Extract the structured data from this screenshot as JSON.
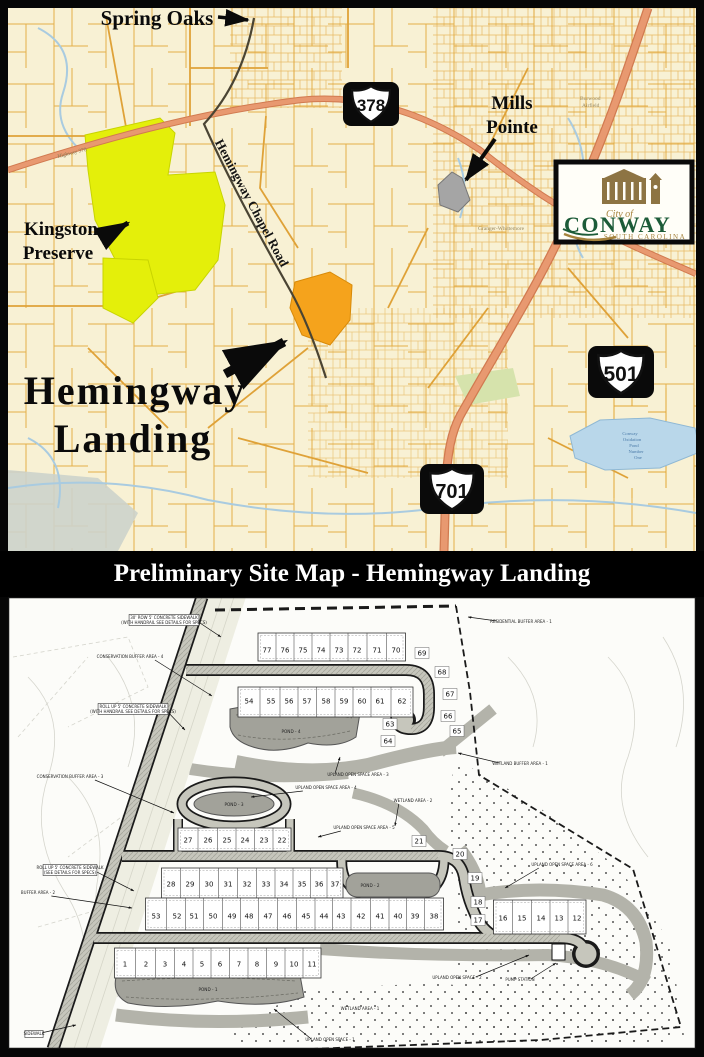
{
  "location_map": {
    "labels": {
      "spring_oaks": "Spring Oaks",
      "mills_pointe": [
        "Mills",
        "Pointe"
      ],
      "kingston": [
        "Kingston",
        "Preserve"
      ],
      "hemingway": [
        "Hemingway",
        "Landing"
      ],
      "road_name": "Hemingway Chapel Road",
      "highway_small": "Highway 378",
      "granger": "Granger-Whittemore",
      "burwood": [
        "Burwood",
        "Airfield"
      ],
      "lake": [
        "Conway",
        "Oxidation",
        "Pond",
        "Number",
        "One"
      ]
    },
    "shields": [
      {
        "number": "378"
      },
      {
        "number": "501"
      },
      {
        "number": "701"
      }
    ],
    "logo": {
      "prefix": "City of",
      "name": "CONWAY",
      "sub": "SOUTH CAROLINA"
    },
    "colors": {
      "map_bg": "#f8f1d4",
      "parcel_line": "#e1a430",
      "major_road": "#e89970",
      "water": "#b9d7ea",
      "preserve_yellow": "#e4ef0a",
      "site_orange": "#f5a31c",
      "pointe_gray": "#a5a5a5",
      "logo_green": "#1c5b38",
      "logo_gold": "#a5823c"
    }
  },
  "title_bar": {
    "text": "Preliminary Site Map - Hemingway Landing"
  },
  "site_plan": {
    "rows": [
      {
        "nums": [
          "77",
          "76",
          "75",
          "74",
          "73",
          "72",
          "71",
          "70"
        ],
        "xs": [
          259,
          277,
          295,
          313,
          331,
          349,
          369,
          388
        ],
        "yNum": 53,
        "y0": 36,
        "y1": 64
      },
      {
        "nums": [
          "54",
          "55",
          "56",
          "57",
          "58",
          "59",
          "60",
          "61",
          "62"
        ],
        "xs": [
          241,
          263,
          281,
          299,
          318,
          336,
          354,
          372,
          394
        ],
        "yNum": 104,
        "y0": 90,
        "y1": 120
      },
      {
        "nums": [
          "27",
          "26",
          "25",
          "24",
          "23",
          "22"
        ],
        "xs": [
          180,
          200,
          219,
          237,
          256,
          274
        ],
        "yNum": 243,
        "y0": 231,
        "y1": 254
      },
      {
        "nums": [
          "28",
          "29",
          "30",
          "31",
          "32",
          "33",
          "34",
          "35",
          "36",
          "37"
        ],
        "xs": [
          163,
          182,
          201,
          220,
          239,
          258,
          276,
          294,
          311,
          327
        ],
        "yNum": 287,
        "y0": 271,
        "y1": 301
      },
      {
        "nums": [
          "53",
          "52",
          "51",
          "50",
          "49",
          "48",
          "47",
          "46",
          "45",
          "44",
          "43",
          "42",
          "41",
          "40",
          "39",
          "38"
        ],
        "xs": [
          148,
          169,
          186,
          205,
          224,
          241,
          260,
          279,
          298,
          316,
          333,
          353,
          372,
          390,
          407,
          426
        ],
        "yNum": 319,
        "y0": 301,
        "y1": 333
      },
      {
        "nums": [
          "1",
          "2",
          "3",
          "4",
          "5",
          "6",
          "7",
          "8",
          "9",
          "10",
          "11"
        ],
        "xs": [
          117,
          138,
          157,
          176,
          194,
          212,
          231,
          249,
          268,
          286,
          304
        ],
        "yNum": 367,
        "y0": 351,
        "y1": 381
      },
      {
        "nums": [
          "16",
          "15",
          "14",
          "13",
          "12"
        ],
        "xs": [
          495,
          514,
          533,
          551,
          569
        ],
        "yNum": 321,
        "y0": 303,
        "y1": 337
      }
    ],
    "singles": [
      {
        "n": "69",
        "x": 414,
        "y": 56
      },
      {
        "n": "68",
        "x": 434,
        "y": 75
      },
      {
        "n": "67",
        "x": 442,
        "y": 97
      },
      {
        "n": "66",
        "x": 440,
        "y": 119
      },
      {
        "n": "65",
        "x": 449,
        "y": 134
      },
      {
        "n": "63",
        "x": 382,
        "y": 127
      },
      {
        "n": "64",
        "x": 380,
        "y": 144
      },
      {
        "n": "21",
        "x": 411,
        "y": 244
      },
      {
        "n": "20",
        "x": 452,
        "y": 257
      },
      {
        "n": "19",
        "x": 467,
        "y": 281
      },
      {
        "n": "18",
        "x": 470,
        "y": 305
      },
      {
        "n": "17",
        "x": 470,
        "y": 323
      }
    ],
    "ponds": [
      {
        "label": "POND - 4",
        "x": 283,
        "y": 136
      },
      {
        "label": "POND - 3",
        "x": 226,
        "y": 209
      },
      {
        "label": "POND - 2",
        "x": 362,
        "y": 290
      },
      {
        "label": "POND - 1",
        "x": 200,
        "y": 394
      }
    ],
    "annotations": [
      {
        "t": "30' ROW 5' CONCRETE SIDEWALK",
        "t2": "(WITH HANDRAIL SEE DETAILS FOR SPECS)",
        "x": 156,
        "y": 22,
        "box": true,
        "ax": 213,
        "ay": 40
      },
      {
        "t": "CONSERVATION BUFFER AREA - 4",
        "x": 122,
        "y": 61,
        "ax": 204,
        "ay": 99
      },
      {
        "t": "ROLL UP 5' CONCRETE SIDEWALK",
        "t2": "(WITH HANDRAIL SEE DETAILS FOR SPECS)",
        "x": 125,
        "y": 111,
        "box": true,
        "ax": 177,
        "ay": 133
      },
      {
        "t": "RESIDENTIAL BUFFER AREA - 1",
        "x": 513,
        "y": 26,
        "ax": 460,
        "ay": 20
      },
      {
        "t": "WETLAND BUFFER AREA - 1",
        "x": 512,
        "y": 168,
        "ax": 450,
        "ay": 156
      },
      {
        "t": "WETLAND AREA - 2",
        "x": 405,
        "y": 205,
        "ax": 387,
        "ay": 229
      },
      {
        "t": "UPLAND OPEN SPACE AREA - 3",
        "x": 350,
        "y": 179,
        "ax": 332,
        "ay": 160
      },
      {
        "t": "UPLAND OPEN SPACE AREA - 4",
        "x": 318,
        "y": 192,
        "ax": 243,
        "ay": 200
      },
      {
        "t": "UPLAND OPEN SPACE AREA - 5",
        "x": 356,
        "y": 232,
        "ax": 310,
        "ay": 240
      },
      {
        "t": "UPLAND OPEN SPACE AREA - 6",
        "x": 554,
        "y": 269,
        "ax": 497,
        "ay": 291
      },
      {
        "t": "CONSERVATION BUFFER AREA - 3",
        "x": 62,
        "y": 181,
        "ax": 166,
        "ay": 216
      },
      {
        "t": "BUFFER AREA - 2",
        "x": 30,
        "y": 297,
        "ax": 124,
        "ay": 311
      },
      {
        "t": "ROLL UP 5' CONCRETE SIDEWALK",
        "t2": "(SEE DETAILS FOR SPECS)",
        "x": 62,
        "y": 272,
        "box": true,
        "ax": 126,
        "ay": 294
      },
      {
        "t": "UPLAND OPEN SPACE - 1",
        "x": 322,
        "y": 444,
        "ax": 266,
        "ay": 412
      },
      {
        "t": "UPLAND OPEN SPACE - 2",
        "x": 449,
        "y": 382,
        "ax": 521,
        "ay": 358
      },
      {
        "t": "PUMP STATION",
        "x": 512,
        "y": 384,
        "ax": 548,
        "ay": 366
      },
      {
        "t": "WETLAND AREA - 1",
        "x": 352,
        "y": 413
      },
      {
        "t": "SIDEWALK",
        "x": 26,
        "y": 438,
        "box": true,
        "ax": 68,
        "ay": 428
      }
    ]
  }
}
